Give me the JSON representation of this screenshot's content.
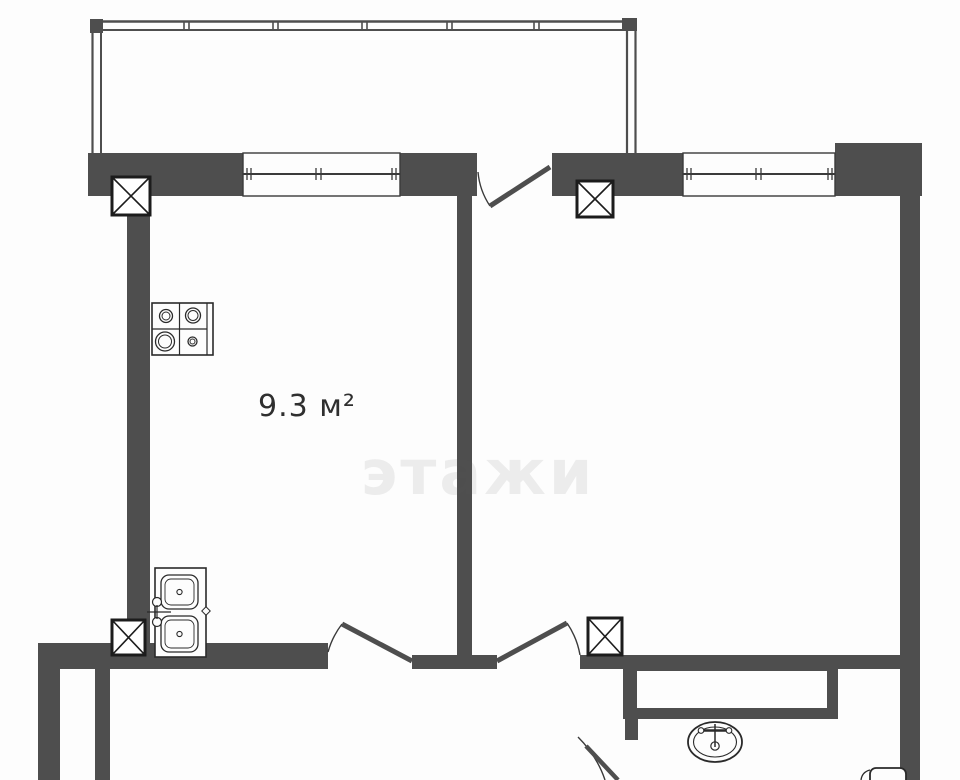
{
  "plan": {
    "room_label": "9.3 м²",
    "watermark": "этажи",
    "colors": {
      "wall": "#4e4e4e",
      "line": "#262626",
      "background": "#fdfdfd"
    },
    "fixtures": [
      "stove-4-burner",
      "double-kitchen-sink",
      "oval-washbasin",
      "toilet-cistern",
      "shaft-column-x4",
      "balcony-glazing",
      "window-x2",
      "door-x4"
    ]
  }
}
